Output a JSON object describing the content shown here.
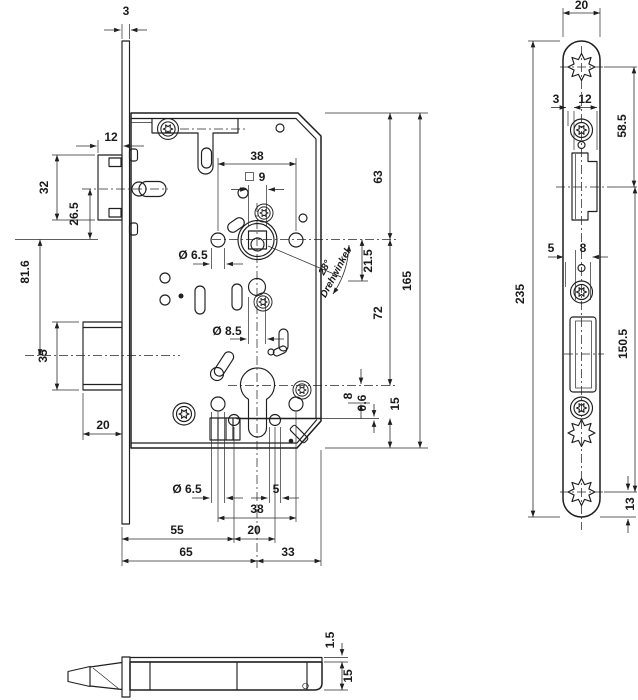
{
  "main_view": {
    "dims": {
      "faceplate_thickness": "3",
      "latch_protrusion": "12",
      "latch_height": "32",
      "latch_to_nut": "26.5",
      "nut_to_bolt_axis": "81.6",
      "bolt_height": "35",
      "bolt_protrusion": "20",
      "top_hole_spacing": "38",
      "spindle_square": "9",
      "top_hole_dia": "Ø 6.5",
      "center_hole_dia": "Ø 8.5",
      "handle_angle": "28°",
      "handle_angle_label": "Drehwinkel",
      "angle_travel": "21.5",
      "top_to_nut": "63",
      "nut_to_cylinder": "72",
      "cyl_to_row": "8",
      "flange_offset": "0.6",
      "flange_to_bottom": "15",
      "case_height": "165",
      "bottom_hole_dia": "Ø 6.5",
      "small_hole_dia": "5",
      "bottom_hole_spacing": "38",
      "backset_alt": "55",
      "small_hole_spacing": "20",
      "backset": "65",
      "axis_to_back": "33"
    }
  },
  "faceplate_view": {
    "dims": {
      "width": "20",
      "edge_offset": "3",
      "latch_cutout_width": "12",
      "screw_to_latch_axis": "58.5",
      "slot_offset": "5",
      "slot_width": "8",
      "length": "235",
      "latch_axis_to_bottom_screw": "150.5",
      "bottom_screw_to_end": "13"
    }
  },
  "bottom_view": {
    "dims": {
      "cover_thickness": "1.5",
      "case_depth": "15"
    }
  }
}
